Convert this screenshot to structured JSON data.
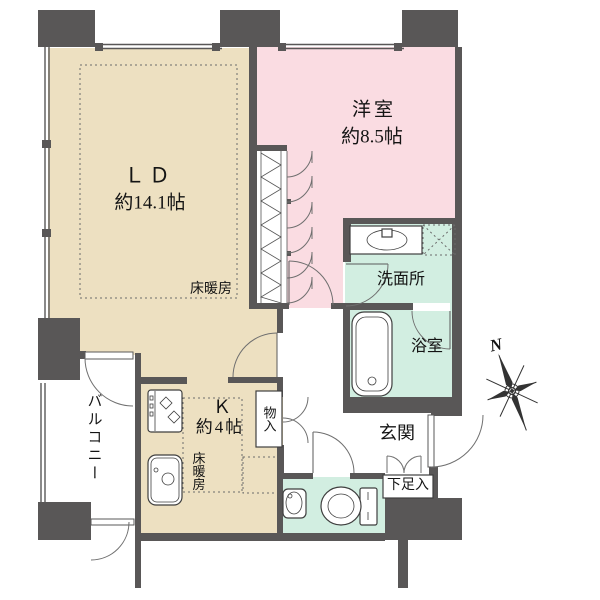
{
  "rooms": {
    "living_dining": {
      "label": "ＬＤ",
      "size": "約14.1帖",
      "floor_heating": "床暖房"
    },
    "western_room": {
      "label": "洋室",
      "size": "約8.5帖"
    },
    "washroom": {
      "label": "洗面所"
    },
    "bathroom": {
      "label": "浴室"
    },
    "kitchen": {
      "label": "Ｋ",
      "size": "約4帖",
      "floor_heating": "床暖房"
    },
    "entrance": {
      "label": "玄関"
    },
    "balcony": {
      "label": "バルコニー"
    },
    "storage": {
      "label": "物入"
    },
    "shoe_cabinet": {
      "label": "下足入"
    }
  },
  "compass": {
    "north_label": "N"
  },
  "colors": {
    "wall": "#595757",
    "ld_kitchen_floor": "#EDE0C1",
    "western_room_floor": "#FADCE2",
    "wet_area_floor": "#D2EEE1",
    "background": "#FFFFFF"
  }
}
